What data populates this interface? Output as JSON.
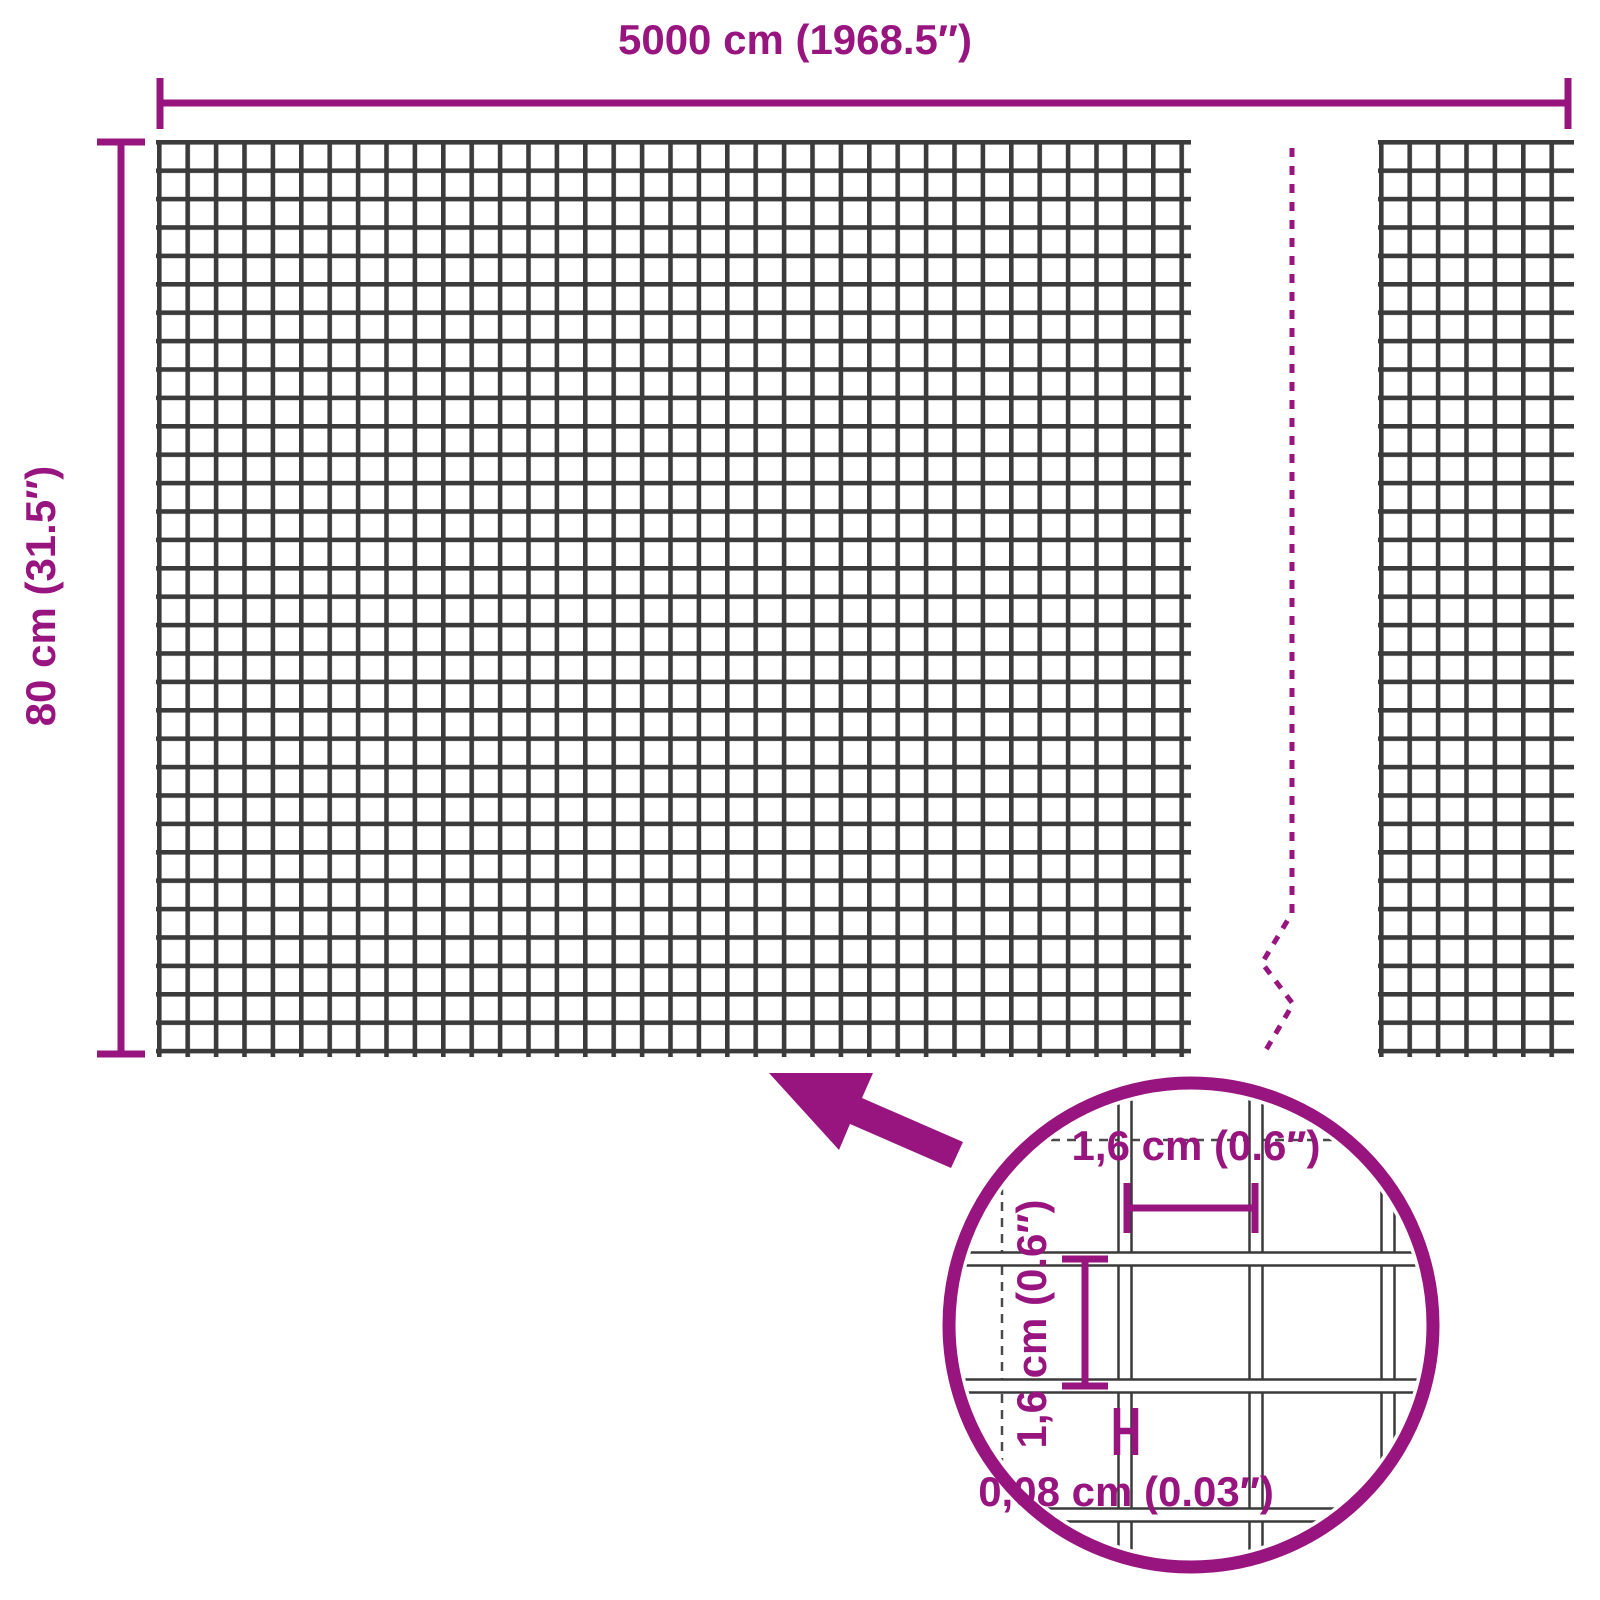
{
  "colors": {
    "accent": "#981580",
    "mesh_wire": "#3b3b3b",
    "detail_wire_outline": "#3a3a3a",
    "background": "#ffffff"
  },
  "dimensions": {
    "width": {
      "label": "5000 cm (1968.5″)"
    },
    "height": {
      "label": "80 cm (31.5″)"
    }
  },
  "detail": {
    "mesh_pitch_horizontal": {
      "label": "1,6 cm (0.6″)"
    },
    "mesh_pitch_vertical": {
      "label": "1,6 cm (0.6″)"
    },
    "wire_thickness": {
      "label": "0,08 cm (0.03″)"
    }
  }
}
